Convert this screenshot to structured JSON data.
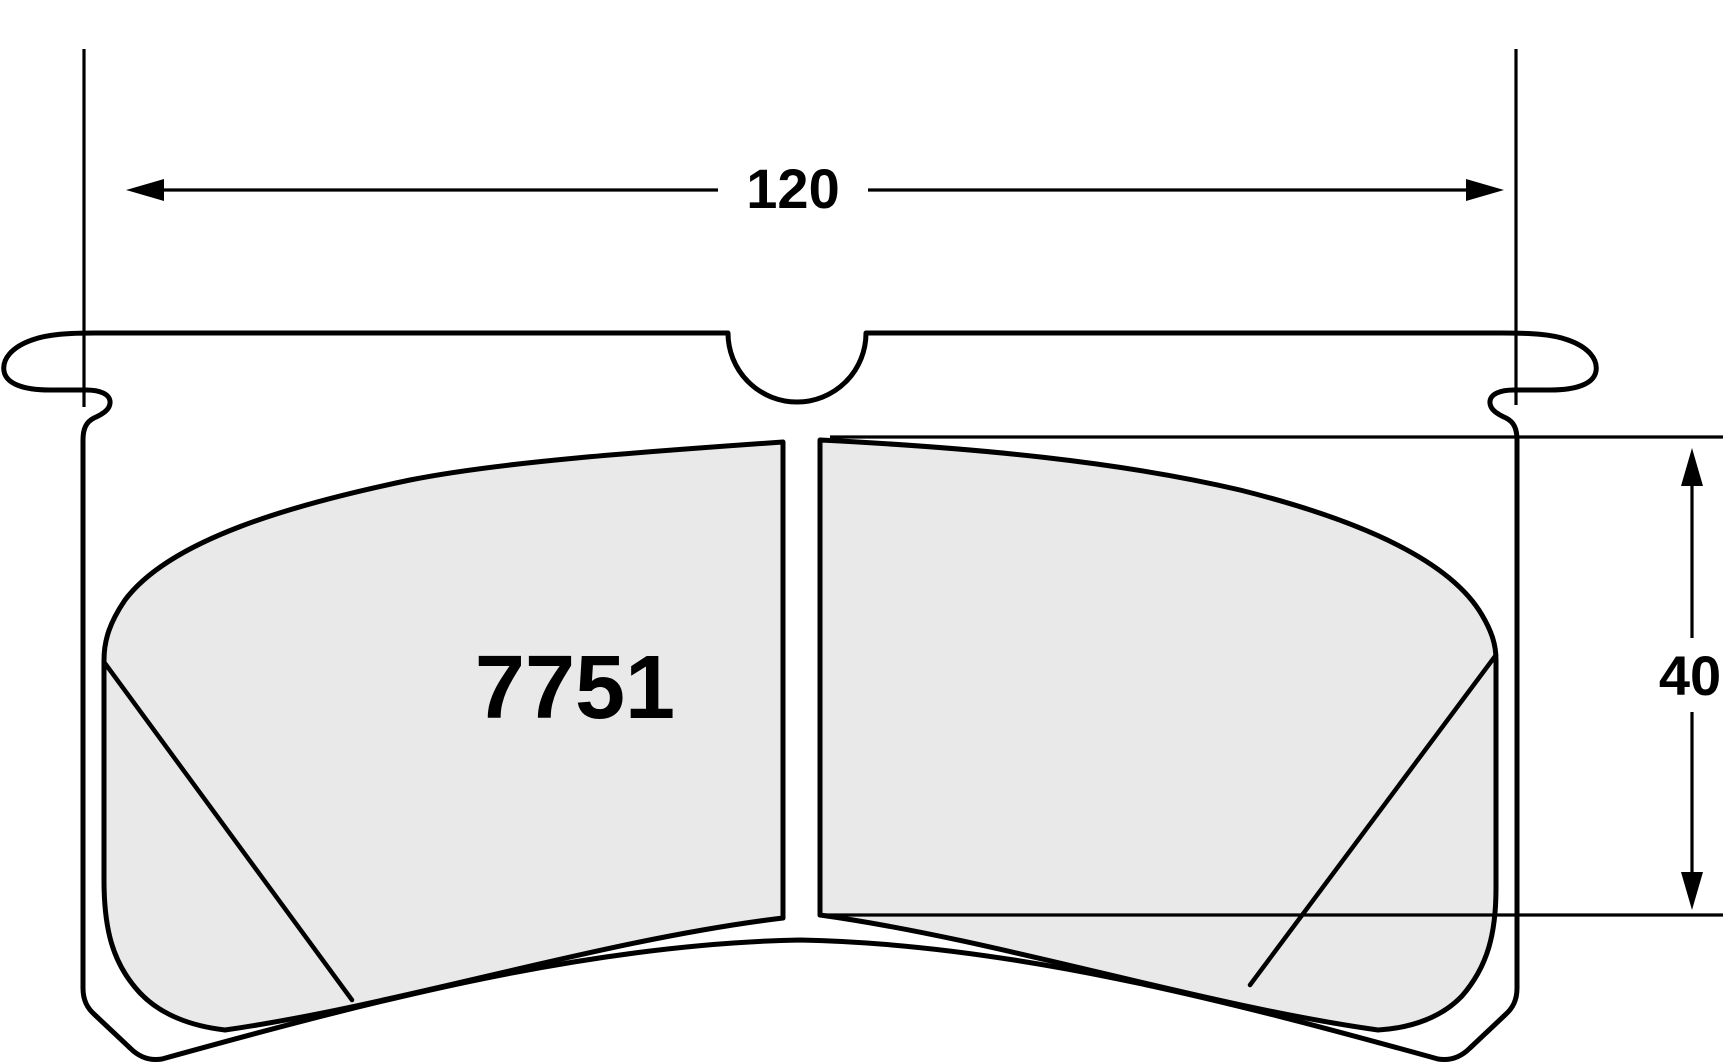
{
  "drawing": {
    "type": "brake-pad-dimensional-drawing",
    "part_number": "7751",
    "dim_width": "120",
    "dim_height": "40",
    "colors": {
      "line": "#000000",
      "friction_fill": "#e9e9e9",
      "background": "#ffffff"
    }
  }
}
